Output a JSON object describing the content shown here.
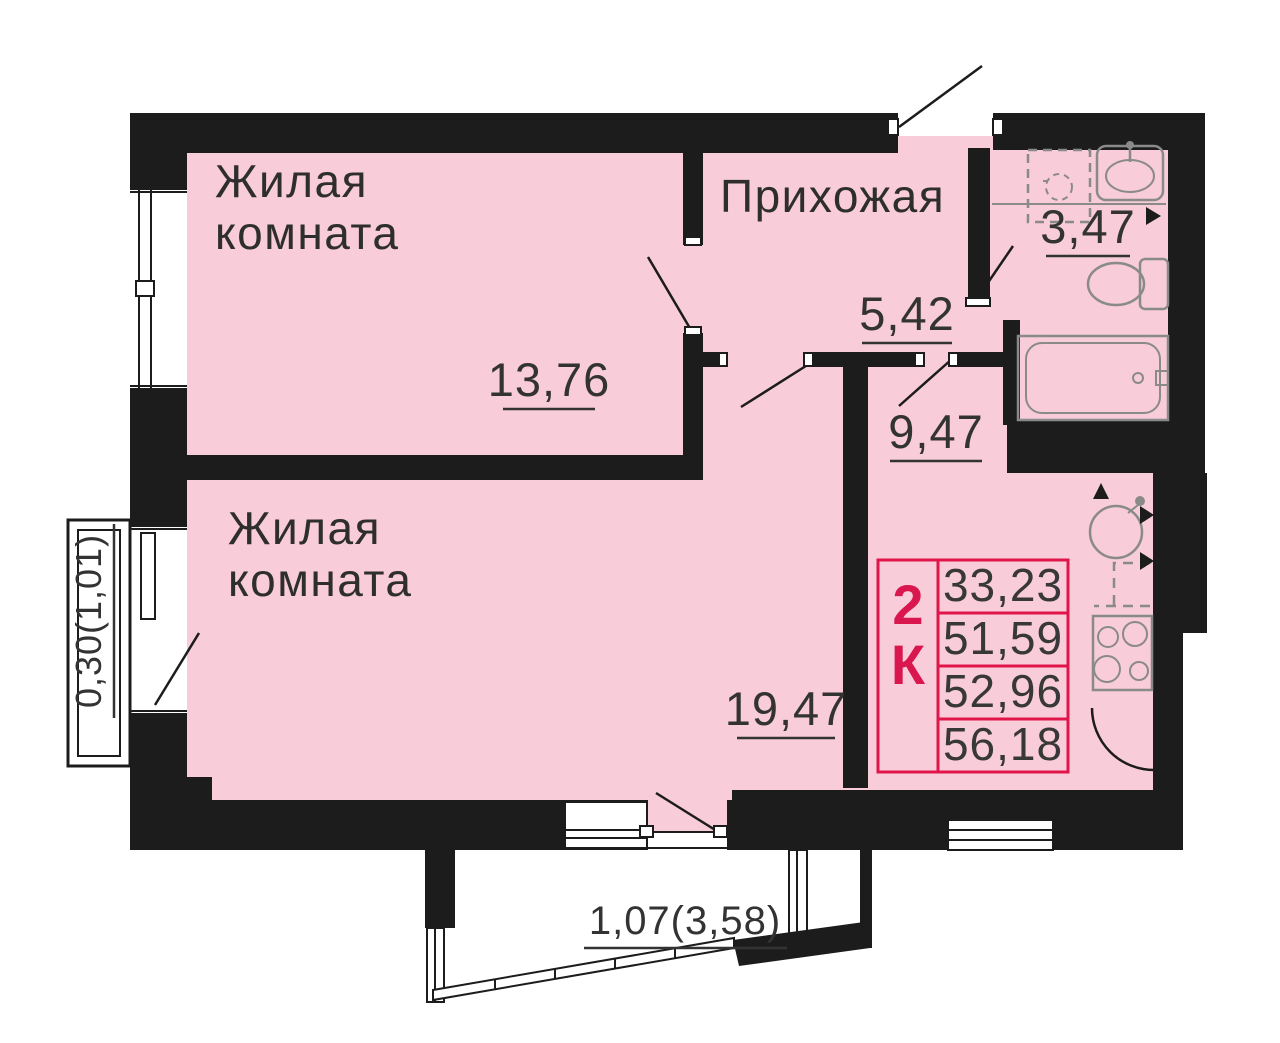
{
  "plan_type": "apartment-floor-plan-2k",
  "colors": {
    "floor_pink": "#f8ccd8",
    "wall_black": "#1c1c1c",
    "table_red": "#e0164b",
    "type_red": "#d9164e",
    "fixture_gray": "#8a8a8a",
    "label_text": "#2e2e2e"
  },
  "rooms": {
    "living_room_top": {
      "label_line1": "Жилая",
      "label_line2": "комната",
      "area": "13,76"
    },
    "living_room_bottom": {
      "label_line1": "Жилая",
      "label_line2": "комната",
      "area": "19,47"
    },
    "hallway": {
      "label": "Прихожая",
      "area": "5,42"
    },
    "bathroom": {
      "area": "3,47"
    },
    "kitchen": {
      "area": "9,47"
    }
  },
  "dimensions": {
    "left_loggia": "0,30(1,01)",
    "bottom_balcony": "1,07(3,58)"
  },
  "info_table": {
    "type_digit": "2",
    "type_letter": "К",
    "rows": [
      "33,23",
      "51,59",
      "52,96",
      "56,18"
    ]
  }
}
